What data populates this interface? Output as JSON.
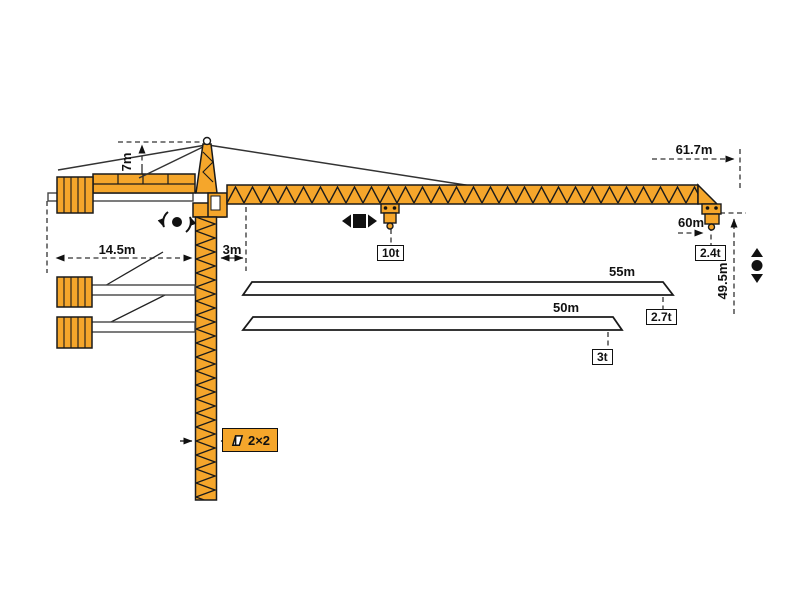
{
  "diagram": {
    "type": "tower-crane-load-diagram",
    "colors": {
      "crane": "#F5A62B",
      "line": "#1A1A1A",
      "dash": "#333333"
    },
    "labels": {
      "tower_head_height": "7m",
      "counter_jib_radius": "14.5m",
      "min_radius": "3m",
      "jib_length_max": "61.7m",
      "tip_radius": "60m",
      "tip_capacity": "2.4t",
      "hook_height": "49.5m",
      "max_capacity": "10t",
      "tower_section": "2×2"
    },
    "jib_options": [
      {
        "length": "55m",
        "tip_capacity": "2.7t"
      },
      {
        "length": "50m",
        "tip_capacity": "3t"
      }
    ],
    "icons": {
      "slew": "slewing rotation",
      "trolley": "trolley travel",
      "hoist": "hook hoisting"
    }
  }
}
